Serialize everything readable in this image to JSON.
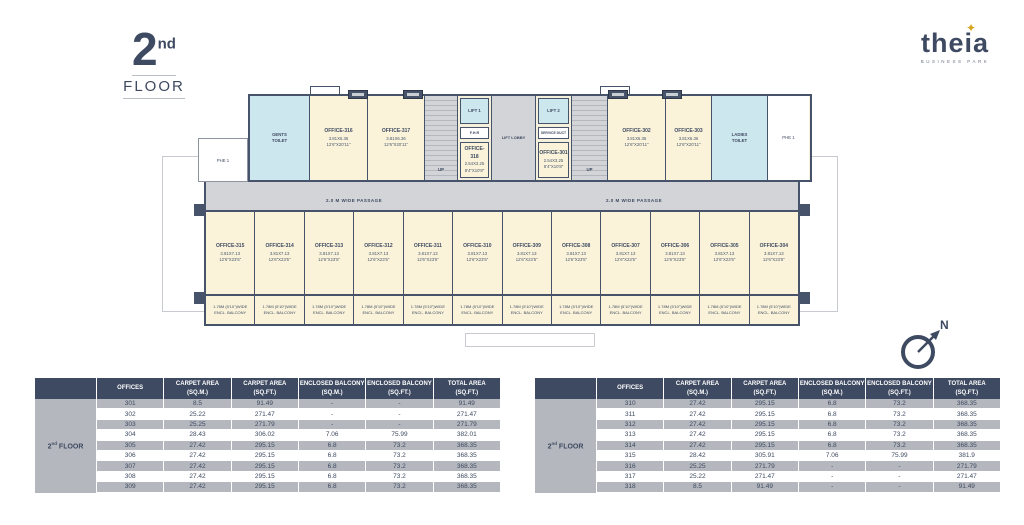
{
  "header": {
    "floor_big": "2",
    "floor_sup": "nd",
    "floor_word": "FLOOR",
    "brand": {
      "name": "theia",
      "star": "✦",
      "tagline": "BUSINESS PARK"
    }
  },
  "plan": {
    "passage_label": "2.0 M WIDE PASSAGE",
    "lift_lobby": "LIFT LOBBY",
    "lift1": "LIFT 1",
    "lift2": "LIFT 2",
    "fhr": "F.H.R",
    "service_duct": "SERVICE DUCT",
    "up": "UP",
    "gents_l1": "GENTS",
    "gents_l2": "TOILET",
    "ladies_l1": "LADIES",
    "ladies_l2": "TOILET",
    "phe_left": "PHE 1",
    "phe_right": "PHE 1",
    "compass_n": "N",
    "balcony_l1": "1.78M (5'10\")WIDE",
    "balcony_l2": "ENCL. BALCONY",
    "top_rooms": [
      {
        "name": "OFFICE-316",
        "dim_m": "3.81X6.36",
        "dim_ft": "12'6\"X20'11\""
      },
      {
        "name": "OFFICE-317",
        "dim_m": "3.81X6.36",
        "dim_ft": "12'6\"X20'11\""
      },
      {
        "name": "OFFICE-318",
        "dim_m": "2.54X3.25",
        "dim_ft": "8'4\"X10'8\""
      },
      {
        "name": "OFFICE-301",
        "dim_m": "2.54X3.25",
        "dim_ft": "8'4\"X10'8\""
      },
      {
        "name": "OFFICE-302",
        "dim_m": "3.81X6.36",
        "dim_ft": "12'6\"X20'11\""
      },
      {
        "name": "OFFICE-303",
        "dim_m": "3.81X6.36",
        "dim_ft": "12'6\"X20'11\""
      }
    ],
    "bottom_offices": [
      {
        "name": "OFFICE-315",
        "dim_m": "3.81X7.13",
        "dim_ft": "12'6\"X23'5\""
      },
      {
        "name": "OFFICE-314",
        "dim_m": "3.81X7.13",
        "dim_ft": "12'6\"X23'5\""
      },
      {
        "name": "OFFICE-313",
        "dim_m": "3.81X7.13",
        "dim_ft": "12'6\"X23'5\""
      },
      {
        "name": "OFFICE-312",
        "dim_m": "3.81X7.13",
        "dim_ft": "12'6\"X23'5\""
      },
      {
        "name": "OFFICE-311",
        "dim_m": "3.81X7.13",
        "dim_ft": "12'6\"X23'5\""
      },
      {
        "name": "OFFICE-310",
        "dim_m": "3.81X7.13",
        "dim_ft": "12'6\"X23'5\""
      },
      {
        "name": "OFFICE-309",
        "dim_m": "3.81X7.13",
        "dim_ft": "12'6\"X23'5\""
      },
      {
        "name": "OFFICE-308",
        "dim_m": "3.81X7.13",
        "dim_ft": "12'6\"X23'5\""
      },
      {
        "name": "OFFICE-307",
        "dim_m": "3.81X7.13",
        "dim_ft": "12'6\"X23'5\""
      },
      {
        "name": "OFFICE-306",
        "dim_m": "3.81X7.13",
        "dim_ft": "12'6\"X23'5\""
      },
      {
        "name": "OFFICE-305",
        "dim_m": "3.81X7.13",
        "dim_ft": "12'6\"X23'5\""
      },
      {
        "name": "OFFICE-304",
        "dim_m": "3.81X7.13",
        "dim_ft": "12'6\"X23'5\""
      }
    ]
  },
  "tables": [
    {
      "floor": {
        "num": "2",
        "sup": "nd",
        "word": "FLOOR"
      },
      "headers": [
        {
          "l1": "OFFICES",
          "l2": ""
        },
        {
          "l1": "CARPET AREA",
          "l2": "(SQ.M.)"
        },
        {
          "l1": "CARPET AREA",
          "l2": "(SQ.FT.)"
        },
        {
          "l1": "ENCLOSED BALCONY",
          "l2": "(SQ.M.)"
        },
        {
          "l1": "ENCLOSED BALCONY",
          "l2": "(SQ.FT.)"
        },
        {
          "l1": "TOTAL AREA",
          "l2": "(SQ.FT.)"
        }
      ],
      "rows": [
        [
          "301",
          "8.5",
          "91.49",
          "-",
          "-",
          "91.49"
        ],
        [
          "302",
          "25.22",
          "271.47",
          "-",
          "-",
          "271.47"
        ],
        [
          "303",
          "25.25",
          "271.79",
          "-",
          "-",
          "271.79"
        ],
        [
          "304",
          "28.43",
          "306.02",
          "7.06",
          "75.99",
          "382.01"
        ],
        [
          "305",
          "27.42",
          "295.15",
          "6.8",
          "73.2",
          "368.35"
        ],
        [
          "306",
          "27.42",
          "295.15",
          "6.8",
          "73.2",
          "368.35"
        ],
        [
          "307",
          "27.42",
          "295.15",
          "6.8",
          "73.2",
          "368.35"
        ],
        [
          "308",
          "27.42",
          "295.15",
          "6.8",
          "73.2",
          "368.35"
        ],
        [
          "309",
          "27.42",
          "295.15",
          "6.8",
          "73.2",
          "368.35"
        ]
      ]
    },
    {
      "floor": {
        "num": "2",
        "sup": "nd",
        "word": "FLOOR"
      },
      "headers": [
        {
          "l1": "OFFICES",
          "l2": ""
        },
        {
          "l1": "CARPET AREA",
          "l2": "(SQ.M.)"
        },
        {
          "l1": "CARPET AREA",
          "l2": "(SQ.FT.)"
        },
        {
          "l1": "ENCLOSED BALCONY",
          "l2": "(SQ.M.)"
        },
        {
          "l1": "ENCLOSED BALCONY",
          "l2": "(SQ.FT.)"
        },
        {
          "l1": "TOTAL AREA",
          "l2": "(SQ.FT.)"
        }
      ],
      "rows": [
        [
          "310",
          "27.42",
          "295.15",
          "6.8",
          "73.2",
          "368.35"
        ],
        [
          "311",
          "27.42",
          "295.15",
          "6.8",
          "73.2",
          "368.35"
        ],
        [
          "312",
          "27.42",
          "295.15",
          "6.8",
          "73.2",
          "368.35"
        ],
        [
          "313",
          "27.42",
          "295.15",
          "6.8",
          "73.2",
          "368.35"
        ],
        [
          "314",
          "27.42",
          "295.15",
          "6.8",
          "73.2",
          "368.35"
        ],
        [
          "315",
          "28.42",
          "305.91",
          "7.06",
          "75.99",
          "381.9"
        ],
        [
          "316",
          "25.25",
          "271.79",
          "-",
          "-",
          "271.79"
        ],
        [
          "317",
          "25.22",
          "271.47",
          "-",
          "-",
          "271.47"
        ],
        [
          "318",
          "8.5",
          "91.49",
          "-",
          "-",
          "91.49"
        ]
      ]
    }
  ]
}
